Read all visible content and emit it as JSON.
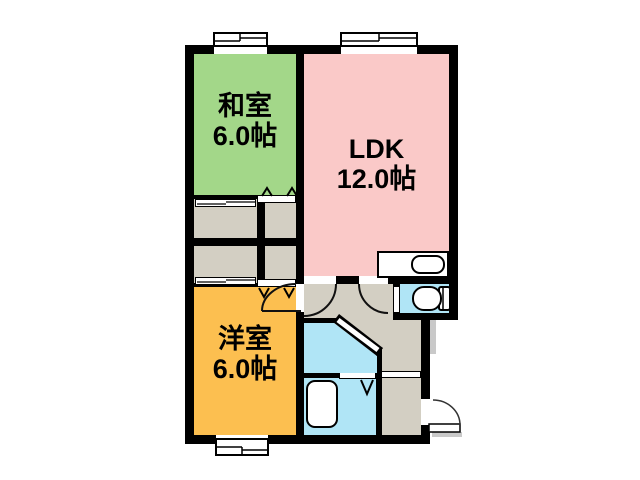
{
  "floorplan": {
    "rooms": [
      {
        "name": "和室",
        "size_label": "6.0帖",
        "color": "#a3d789"
      },
      {
        "name": "LDK",
        "size_label": "12.0帖",
        "color": "#fac9c8"
      },
      {
        "name": "洋室",
        "size_label": "6.0帖",
        "color": "#fcbf50"
      }
    ],
    "zone_colors": {
      "closet_and_hallway": "#d3cfc3",
      "wet_areas": "#b0e5f6",
      "walls": "#000000",
      "background": "#ffffff"
    },
    "fixtures": [
      "kitchen-counter",
      "kitchen-sink",
      "toilet",
      "bathtub",
      "entrance-door",
      "sliding-closet-doors",
      "folding-closet-doors",
      "windows",
      "door-swing-arcs"
    ]
  }
}
